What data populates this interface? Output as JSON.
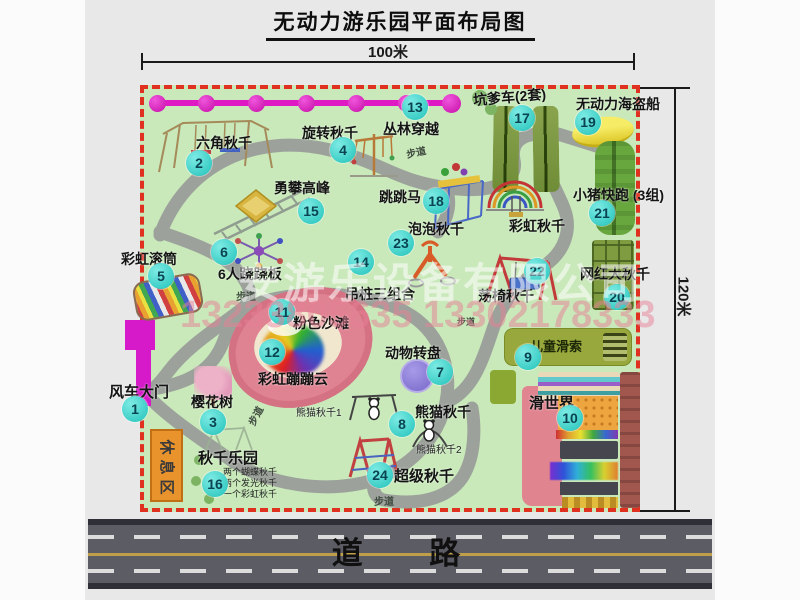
{
  "title": "无动力游乐园平面布局图",
  "dimensions": {
    "top": "100米",
    "right": "120米"
  },
  "road": {
    "label": "道 路"
  },
  "watermark": {
    "company": "安游乐设备有限公司",
    "phone": "13233805635 13302178333"
  },
  "path_label": "步道",
  "rest_area_label": "休息区",
  "rainbow_swing_label": "彩虹秋千",
  "panda_sub1": "熊猫秋千1",
  "panda_sub2": "熊猫秋千2",
  "swing_notes": [
    "两个蝴蝶秋千",
    "两个发光秋千",
    "一个彩虹秋千"
  ],
  "attractions": {
    "a1": {
      "num": "1",
      "label": "风车大门"
    },
    "a2": {
      "num": "2",
      "label": "六角秋千"
    },
    "a3": {
      "num": "3",
      "label": "樱花树"
    },
    "a4": {
      "num": "4",
      "label": "旋转秋千"
    },
    "a5": {
      "num": "5",
      "label": "彩虹滚筒"
    },
    "a6": {
      "num": "6",
      "label": "6人跷跷板"
    },
    "a7": {
      "num": "7",
      "label": "动物转盘"
    },
    "a8": {
      "num": "8",
      "label": "熊猫秋千"
    },
    "a9": {
      "num": "9",
      "label": "儿童滑索"
    },
    "a10": {
      "num": "10",
      "label": "滑世界"
    },
    "a11": {
      "num": "11",
      "label": "粉色沙滩"
    },
    "a12": {
      "num": "12",
      "label": "彩虹蹦蹦云"
    },
    "a13": {
      "num": "13",
      "label": "丛林穿越"
    },
    "a14": {
      "num": "14",
      "label": "吊桩三组合"
    },
    "a15": {
      "num": "15",
      "label": "勇攀高峰"
    },
    "a16": {
      "num": "16",
      "label": "秋千乐园"
    },
    "a17": {
      "num": "17",
      "label": "坑爹车(2套)"
    },
    "a18": {
      "num": "18",
      "label": "跳跳马"
    },
    "a19": {
      "num": "19",
      "label": "无动力海盗船"
    },
    "a20": {
      "num": "20",
      "label": "网红大秋千"
    },
    "a21": {
      "num": "21",
      "label": "小猪快跑 (3组)"
    },
    "a22": {
      "num": "22",
      "label": "荡椅秋千"
    },
    "a23": {
      "num": "23",
      "label": "泡泡秋千"
    },
    "a24": {
      "num": "24",
      "label": "超级秋千"
    }
  }
}
